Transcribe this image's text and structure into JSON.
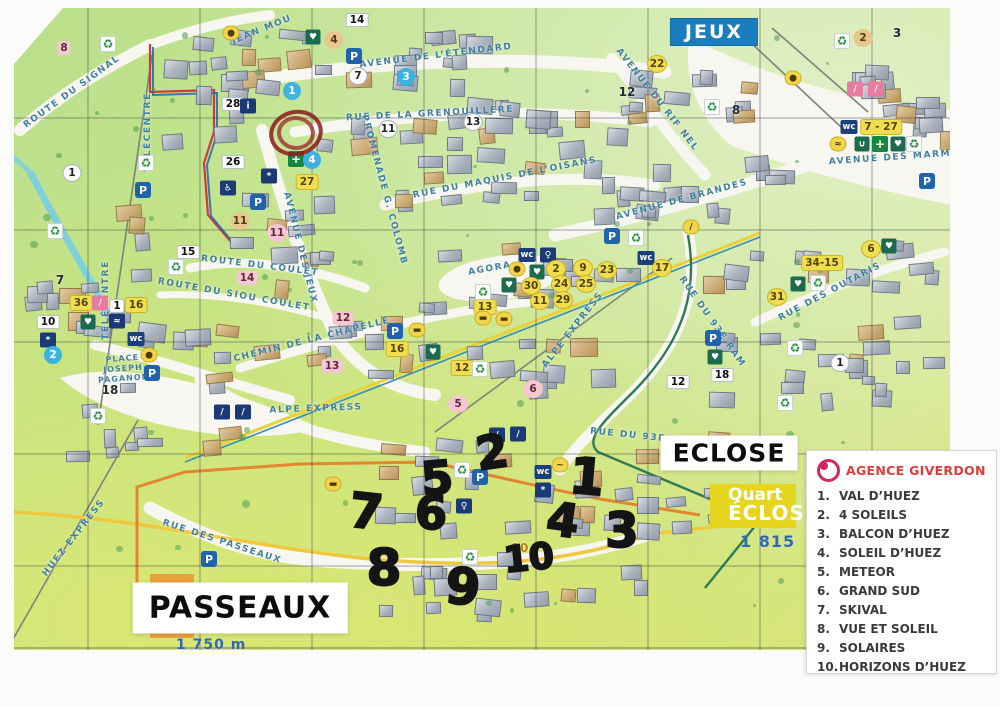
{
  "colors": {
    "banner_blue": "#1a7dc0",
    "quartier_yellow": "#e5d51f",
    "quartier_orange": "#e8a23c",
    "elevation_blue": "#2f69b5",
    "legend_red": "#e23b3b",
    "boundary_red": "#cf3a3a",
    "boundary_yellow": "#eec93e",
    "street_blue": "#41809f"
  },
  "legend": {
    "agency": "AGENCE GIVERDON",
    "logo": "agence-giverdon-logo",
    "items": [
      {
        "n": "1.",
        "t": "VAL D’HUEZ"
      },
      {
        "n": "2.",
        "t": "4 SOLEILS"
      },
      {
        "n": "3.",
        "t": "BALCON D’HUEZ"
      },
      {
        "n": "4.",
        "t": "SOLEIL D’HUEZ"
      },
      {
        "n": "5.",
        "t": "METEOR"
      },
      {
        "n": "6.",
        "t": "GRAND SUD"
      },
      {
        "n": "7.",
        "t": "SKIVAL"
      },
      {
        "n": "8.",
        "t": "VUE ET SOLEIL"
      },
      {
        "n": "9.",
        "t": "SOLAIRES"
      },
      {
        "n": "10.",
        "t": "HORIZONS D’HUEZ"
      }
    ]
  },
  "map": {
    "area_labels": [
      {
        "text": "JEUX",
        "style": "banner",
        "x": 714,
        "y": 32
      },
      {
        "text": "ECLOSE",
        "style": "whitebox al-eclose",
        "x": 729,
        "y": 453
      },
      {
        "text": "PASSEAUX",
        "style": "whitebox al-passeaux",
        "x": 240,
        "y": 608
      }
    ],
    "quartier_eclose": {
      "line1": "Quart",
      "line2": "ÉCLOS",
      "elevation": "1 815"
    },
    "quartier_passeaux": {
      "letter": "P",
      "elevation": "1 750 m"
    },
    "streets": [
      {
        "name": "ROUTE DU SIGNAL",
        "x": 72,
        "y": 92,
        "rot": -36
      },
      {
        "name": "TÉLÉCENTRE",
        "x": 148,
        "y": 132,
        "rot": -90
      },
      {
        "name": "TÉLÉCENTRE",
        "x": 106,
        "y": 300,
        "rot": -90
      },
      {
        "name": "JEAN MOU",
        "x": 262,
        "y": 30,
        "rot": -22
      },
      {
        "name": "AVENUE DE L’ÉTENDARD",
        "x": 436,
        "y": 56,
        "rot": -7
      },
      {
        "name": "RUE DE LA GRENOUILLÈRE",
        "x": 430,
        "y": 114,
        "rot": -3
      },
      {
        "name": "PROMENADE G. COLOMB",
        "x": 384,
        "y": 190,
        "rot": 75
      },
      {
        "name": "RUE DU MAQUIS DE L’OISANS",
        "x": 505,
        "y": 178,
        "rot": -11
      },
      {
        "name": "AVENUE DE BRANDES",
        "x": 682,
        "y": 200,
        "rot": -15
      },
      {
        "name": "AVENUE DU RIF NEL",
        "x": 657,
        "y": 100,
        "rot": 52
      },
      {
        "name": "AVENUE DES MARM",
        "x": 890,
        "y": 158,
        "rot": -4
      },
      {
        "name": "AVENUE DES JEUX",
        "x": 300,
        "y": 248,
        "rot": 76
      },
      {
        "name": "ROUTE DU COULET",
        "x": 260,
        "y": 266,
        "rot": 7
      },
      {
        "name": "ROUTE DU SIOU COULET",
        "x": 234,
        "y": 295,
        "rot": 10
      },
      {
        "name": "CHEMIN DE LA CHAPELLE",
        "x": 312,
        "y": 340,
        "rot": -14
      },
      {
        "name": "AGORA",
        "x": 490,
        "y": 269,
        "rot": -10
      },
      {
        "name": "ALPE EXPRESS",
        "x": 316,
        "y": 409,
        "rot": -2
      },
      {
        "name": "ALPE EXPRESS",
        "x": 573,
        "y": 330,
        "rot": -52
      },
      {
        "name": "RUE DU 93E RAM",
        "x": 712,
        "y": 322,
        "rot": 55
      },
      {
        "name": "RUE DU 93E RAM",
        "x": 644,
        "y": 437,
        "rot": 6
      },
      {
        "name": "RUE DES OUTARIS",
        "x": 830,
        "y": 292,
        "rot": -28
      },
      {
        "name": "RUE DES PASSEAUX",
        "x": 222,
        "y": 542,
        "rot": 18
      },
      {
        "name": "HUEZ EXPRESS",
        "x": 74,
        "y": 538,
        "rot": -52
      },
      {
        "name": "PLACE JOSEPH PAGANON",
        "x": 123,
        "y": 369,
        "rot": -4,
        "sm": true
      }
    ],
    "icon_names": {
      "ic-parking": "parking-icon",
      "ic-wc": "wc-icon",
      "ic-recycle": "recycle-icon",
      "ic-heart": "defibrillator-heart-icon",
      "ic-cross": "pharmacy-cross-icon",
      "ic-blue": "pictogram-icon",
      "ic-yellow": "service-icon",
      "ic-pink": "ski-school-icon"
    },
    "points": [
      {
        "x": 357,
        "y": 20,
        "t": "whitebox",
        "v": "14"
      },
      {
        "x": 334,
        "y": 40,
        "t": "tan2",
        "v": "4"
      },
      {
        "x": 313,
        "y": 37,
        "t": "ic-heart",
        "v": "♥"
      },
      {
        "x": 231,
        "y": 33,
        "t": "ic-yellow",
        "v": "●"
      },
      {
        "x": 354,
        "y": 56,
        "t": "ic-parking",
        "v": "P"
      },
      {
        "x": 292,
        "y": 91,
        "t": "blue",
        "v": "1"
      },
      {
        "x": 358,
        "y": 76,
        "t": "white",
        "v": "7"
      },
      {
        "x": 406,
        "y": 77,
        "t": "blue",
        "v": "3"
      },
      {
        "x": 388,
        "y": 129,
        "t": "white",
        "v": "11"
      },
      {
        "x": 473,
        "y": 122,
        "t": "white",
        "v": "13"
      },
      {
        "x": 233,
        "y": 104,
        "t": "whitebox",
        "v": "28"
      },
      {
        "x": 248,
        "y": 106,
        "t": "ic-blue",
        "v": "i"
      },
      {
        "x": 108,
        "y": 44,
        "t": "ic-recycle",
        "v": "♻"
      },
      {
        "x": 64,
        "y": 48,
        "t": "pinkbox",
        "v": "8"
      },
      {
        "x": 143,
        "y": 190,
        "t": "ic-parking",
        "v": "P"
      },
      {
        "x": 146,
        "y": 163,
        "t": "ic-recycle",
        "v": "♻"
      },
      {
        "x": 72,
        "y": 173,
        "t": "white",
        "v": "1"
      },
      {
        "x": 188,
        "y": 252,
        "t": "whitebox",
        "v": "15"
      },
      {
        "x": 657,
        "y": 64,
        "t": "yellow",
        "v": "22"
      },
      {
        "x": 627,
        "y": 92,
        "t": "plain",
        "v": "12"
      },
      {
        "x": 736,
        "y": 110,
        "t": "plain",
        "v": "8"
      },
      {
        "x": 712,
        "y": 107,
        "t": "ic-recycle",
        "v": "♻"
      },
      {
        "x": 793,
        "y": 78,
        "t": "ic-yellow",
        "v": "●"
      },
      {
        "x": 863,
        "y": 38,
        "t": "tan2",
        "v": "2"
      },
      {
        "x": 897,
        "y": 33,
        "t": "plain",
        "v": "3"
      },
      {
        "x": 842,
        "y": 41,
        "t": "ic-recycle",
        "v": "♻"
      },
      {
        "x": 855,
        "y": 89,
        "t": "ic-pink",
        "v": "/"
      },
      {
        "x": 876,
        "y": 89,
        "t": "ic-pink",
        "v": "/"
      },
      {
        "x": 849,
        "y": 127,
        "t": "ic-wc",
        "v": "wc"
      },
      {
        "x": 881,
        "y": 127,
        "t": "yellowbox",
        "v": "7 - 27"
      },
      {
        "x": 838,
        "y": 144,
        "t": "ic-yellow",
        "v": "≈"
      },
      {
        "x": 862,
        "y": 144,
        "t": "ic-heart",
        "v": "∪"
      },
      {
        "x": 880,
        "y": 144,
        "t": "ic-cross",
        "v": "+"
      },
      {
        "x": 898,
        "y": 144,
        "t": "ic-heart",
        "v": "♥"
      },
      {
        "x": 914,
        "y": 144,
        "t": "ic-recycle",
        "v": "♻"
      },
      {
        "x": 927,
        "y": 181,
        "t": "ic-parking",
        "v": "P"
      },
      {
        "x": 691,
        "y": 227,
        "t": "ic-yellow",
        "v": "/"
      },
      {
        "x": 889,
        "y": 246,
        "t": "ic-heart",
        "v": "♥"
      },
      {
        "x": 871,
        "y": 249,
        "t": "yellow",
        "v": "6"
      },
      {
        "x": 822,
        "y": 263,
        "t": "yellowbox",
        "v": "34-15"
      },
      {
        "x": 777,
        "y": 297,
        "t": "yellow",
        "v": "31"
      },
      {
        "x": 798,
        "y": 284,
        "t": "ic-heart",
        "v": "♥"
      },
      {
        "x": 818,
        "y": 283,
        "t": "ic-recycle",
        "v": "♻"
      },
      {
        "x": 713,
        "y": 338,
        "t": "ic-parking",
        "v": "P"
      },
      {
        "x": 715,
        "y": 357,
        "t": "ic-heart",
        "v": "♥"
      },
      {
        "x": 722,
        "y": 375,
        "t": "whitebox",
        "v": "18"
      },
      {
        "x": 678,
        "y": 382,
        "t": "whitebox",
        "v": "12"
      },
      {
        "x": 840,
        "y": 363,
        "t": "white",
        "v": "1"
      },
      {
        "x": 795,
        "y": 348,
        "t": "ic-recycle",
        "v": "♻"
      },
      {
        "x": 785,
        "y": 403,
        "t": "ic-recycle",
        "v": "♻"
      },
      {
        "x": 612,
        "y": 236,
        "t": "ic-parking",
        "v": "P"
      },
      {
        "x": 636,
        "y": 238,
        "t": "ic-recycle",
        "v": "♻"
      },
      {
        "x": 646,
        "y": 258,
        "t": "ic-wc",
        "v": "wc"
      },
      {
        "x": 527,
        "y": 255,
        "t": "ic-wc",
        "v": "wc"
      },
      {
        "x": 548,
        "y": 255,
        "t": "ic-blue",
        "v": "♀"
      },
      {
        "x": 517,
        "y": 269,
        "t": "ic-yellow",
        "v": "●"
      },
      {
        "x": 537,
        "y": 272,
        "t": "ic-heart",
        "v": "♥"
      },
      {
        "x": 509,
        "y": 285,
        "t": "ic-heart",
        "v": "♥"
      },
      {
        "x": 556,
        "y": 269,
        "t": "yellow",
        "v": "2"
      },
      {
        "x": 583,
        "y": 268,
        "t": "yellow",
        "v": "9"
      },
      {
        "x": 607,
        "y": 270,
        "t": "yellow",
        "v": "23"
      },
      {
        "x": 662,
        "y": 268,
        "t": "yellow",
        "v": "17"
      },
      {
        "x": 561,
        "y": 284,
        "t": "yellow",
        "v": "24"
      },
      {
        "x": 586,
        "y": 284,
        "t": "yellow",
        "v": "25"
      },
      {
        "x": 531,
        "y": 286,
        "t": "yellow",
        "v": "30"
      },
      {
        "x": 540,
        "y": 301,
        "t": "yellow",
        "v": "11"
      },
      {
        "x": 563,
        "y": 300,
        "t": "yellow",
        "v": "29"
      },
      {
        "x": 485,
        "y": 307,
        "t": "yellowbox",
        "v": "13"
      },
      {
        "x": 483,
        "y": 292,
        "t": "ic-recycle",
        "v": "♻"
      },
      {
        "x": 483,
        "y": 318,
        "t": "ic-yellow",
        "v": "▬"
      },
      {
        "x": 504,
        "y": 319,
        "t": "ic-yellow",
        "v": "▬"
      },
      {
        "x": 176,
        "y": 267,
        "t": "ic-recycle",
        "v": "♻"
      },
      {
        "x": 247,
        "y": 278,
        "t": "pinkbox",
        "v": "14"
      },
      {
        "x": 343,
        "y": 318,
        "t": "pinkbox",
        "v": "12"
      },
      {
        "x": 332,
        "y": 366,
        "t": "pinkbox",
        "v": "13"
      },
      {
        "x": 81,
        "y": 303,
        "t": "yellowbox",
        "v": "36"
      },
      {
        "x": 100,
        "y": 303,
        "t": "ic-pink",
        "v": "/"
      },
      {
        "x": 117,
        "y": 306,
        "t": "whitebox",
        "v": "1"
      },
      {
        "x": 136,
        "y": 305,
        "t": "yellowbox",
        "v": "16"
      },
      {
        "x": 88,
        "y": 322,
        "t": "ic-heart",
        "v": "♥"
      },
      {
        "x": 117,
        "y": 321,
        "t": "ic-blue",
        "v": "≈"
      },
      {
        "x": 136,
        "y": 339,
        "t": "ic-wc",
        "v": "wc"
      },
      {
        "x": 48,
        "y": 322,
        "t": "whitebox",
        "v": "10"
      },
      {
        "x": 48,
        "y": 340,
        "t": "ic-blue",
        "v": "*"
      },
      {
        "x": 55,
        "y": 231,
        "t": "ic-recycle",
        "v": "♻"
      },
      {
        "x": 60,
        "y": 280,
        "t": "plain",
        "v": "7"
      },
      {
        "x": 53,
        "y": 355,
        "t": "blue",
        "v": "2"
      },
      {
        "x": 110,
        "y": 390,
        "t": "plain",
        "v": "18"
      },
      {
        "x": 149,
        "y": 355,
        "t": "ic-yellow",
        "v": "●"
      },
      {
        "x": 152,
        "y": 373,
        "t": "ic-parking",
        "v": "P"
      },
      {
        "x": 98,
        "y": 416,
        "t": "ic-recycle",
        "v": "♻"
      },
      {
        "x": 233,
        "y": 162,
        "t": "whitebox",
        "v": "26"
      },
      {
        "x": 307,
        "y": 182,
        "t": "yellowbox",
        "v": "27"
      },
      {
        "x": 240,
        "y": 221,
        "t": "tan2",
        "v": "11"
      },
      {
        "x": 277,
        "y": 233,
        "t": "pink",
        "v": "11"
      },
      {
        "x": 296,
        "y": 159,
        "t": "ic-cross",
        "v": "+"
      },
      {
        "x": 312,
        "y": 160,
        "t": "blue",
        "v": "4"
      },
      {
        "x": 228,
        "y": 188,
        "t": "ic-blue",
        "v": "♿"
      },
      {
        "x": 269,
        "y": 176,
        "t": "ic-blue",
        "v": "*"
      },
      {
        "x": 258,
        "y": 202,
        "t": "ic-parking",
        "v": "P"
      },
      {
        "x": 222,
        "y": 412,
        "t": "ic-blue",
        "v": "/"
      },
      {
        "x": 243,
        "y": 412,
        "t": "ic-blue",
        "v": "/"
      },
      {
        "x": 395,
        "y": 331,
        "t": "ic-parking",
        "v": "P"
      },
      {
        "x": 417,
        "y": 330,
        "t": "ic-yellow",
        "v": "▬"
      },
      {
        "x": 397,
        "y": 349,
        "t": "yellowbox",
        "v": "16"
      },
      {
        "x": 433,
        "y": 352,
        "t": "ic-heart",
        "v": "♥"
      },
      {
        "x": 462,
        "y": 368,
        "t": "yellowbox",
        "v": "12"
      },
      {
        "x": 480,
        "y": 369,
        "t": "ic-recycle",
        "v": "♻"
      },
      {
        "x": 458,
        "y": 404,
        "t": "pink",
        "v": "5"
      },
      {
        "x": 533,
        "y": 389,
        "t": "pink",
        "v": "6"
      },
      {
        "x": 497,
        "y": 435,
        "t": "ic-blue",
        "v": "/"
      },
      {
        "x": 518,
        "y": 434,
        "t": "ic-blue",
        "v": "/"
      },
      {
        "x": 462,
        "y": 470,
        "t": "ic-recycle",
        "v": "♻"
      },
      {
        "x": 480,
        "y": 477,
        "t": "ic-parking",
        "v": "P"
      },
      {
        "x": 543,
        "y": 472,
        "t": "ic-wc",
        "v": "wc"
      },
      {
        "x": 543,
        "y": 490,
        "t": "ic-blue",
        "v": "*"
      },
      {
        "x": 464,
        "y": 506,
        "t": "ic-blue",
        "v": "♀"
      },
      {
        "x": 560,
        "y": 465,
        "t": "ic-yellow",
        "v": "~"
      },
      {
        "x": 333,
        "y": 484,
        "t": "ic-yellow",
        "v": "▬"
      },
      {
        "x": 209,
        "y": 559,
        "t": "ic-parking",
        "v": "P"
      },
      {
        "x": 470,
        "y": 557,
        "t": "ic-recycle",
        "v": "♻"
      },
      {
        "x": 520,
        "y": 548,
        "t": "orangetext",
        "v": "10"
      }
    ],
    "handwritten": {
      "circle": "red-marker-circle",
      "numbers": [
        {
          "v": "1",
          "x": 587,
          "y": 477,
          "s": 50,
          "r": 5
        },
        {
          "v": "2",
          "x": 492,
          "y": 452,
          "s": 46,
          "r": -8
        },
        {
          "v": "3",
          "x": 622,
          "y": 531,
          "s": 48,
          "r": 0
        },
        {
          "v": "4",
          "x": 563,
          "y": 520,
          "s": 46,
          "r": 8
        },
        {
          "v": "5",
          "x": 437,
          "y": 478,
          "s": 46,
          "r": -5
        },
        {
          "v": "6",
          "x": 431,
          "y": 513,
          "s": 46,
          "r": 0
        },
        {
          "v": "7",
          "x": 366,
          "y": 512,
          "s": 48,
          "r": 6
        },
        {
          "v": "8",
          "x": 384,
          "y": 568,
          "s": 50,
          "r": 0
        },
        {
          "v": "9",
          "x": 463,
          "y": 587,
          "s": 50,
          "r": 5
        },
        {
          "v": "10",
          "x": 529,
          "y": 559,
          "s": 36,
          "r": -6
        }
      ]
    }
  }
}
